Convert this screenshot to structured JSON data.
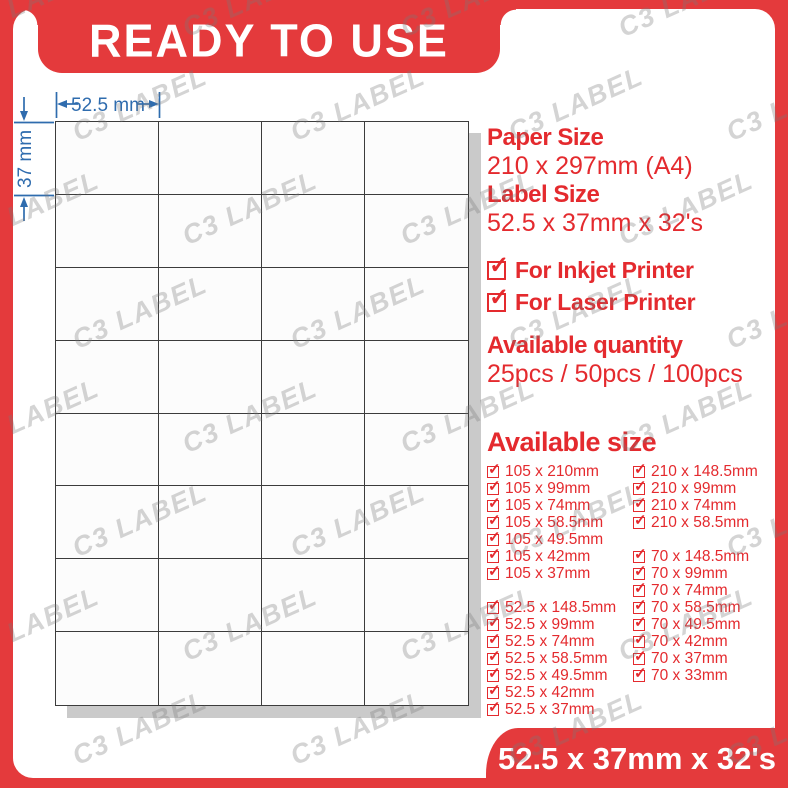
{
  "brand": {
    "watermark": "C3 LABEL"
  },
  "banner": {
    "title": "READY TO USE"
  },
  "sheet": {
    "columns": 4,
    "rows": 8,
    "width_label": "52.5 mm",
    "height_label": "37 mm"
  },
  "specs": {
    "paper_size_label": "Paper Size",
    "paper_size_value": "210 x 297mm (A4)",
    "label_size_label": "Label Size",
    "label_size_value": "52.5 x 37mm x 32's",
    "printer_compat": [
      "For Inkjet Printer",
      "For Laser Printer"
    ],
    "quantity_label": "Available quantity",
    "quantity_value": "25pcs / 50pcs / 100pcs"
  },
  "available_size": {
    "heading": "Available size",
    "left_column": [
      "105 x 210mm",
      "105 x 99mm",
      "105 x 74mm",
      "105 x 58.5mm",
      "105 x 49.5mm",
      "105 x 42mm",
      "105 x 37mm",
      null,
      "52.5 x 148.5mm",
      "52.5 x 99mm",
      "52.5 x 74mm",
      "52.5 x 58.5mm",
      "52.5 x 49.5mm",
      "52.5 x 42mm",
      "52.5 x 37mm"
    ],
    "right_column": [
      "210 x 148.5mm",
      "210 x 99mm",
      "210 x 74mm",
      "210 x 58.5mm",
      null,
      "70 x 148.5mm",
      "70 x 99mm",
      "70 x 74mm",
      "70 x 58.5mm",
      "70 x 49.5mm",
      "70 x 42mm",
      "70 x 37mm",
      "70 x 33mm",
      null,
      null
    ]
  },
  "footer": {
    "size_text": "52.5 x 37mm x 32's"
  },
  "colors": {
    "red": "#e43a3c",
    "text_red": "#e42a2e",
    "blue": "#2f6cae",
    "grid_line": "#3c3c3c",
    "shadow": "#cacaca",
    "watermark_gray": "#7a7a7a"
  }
}
